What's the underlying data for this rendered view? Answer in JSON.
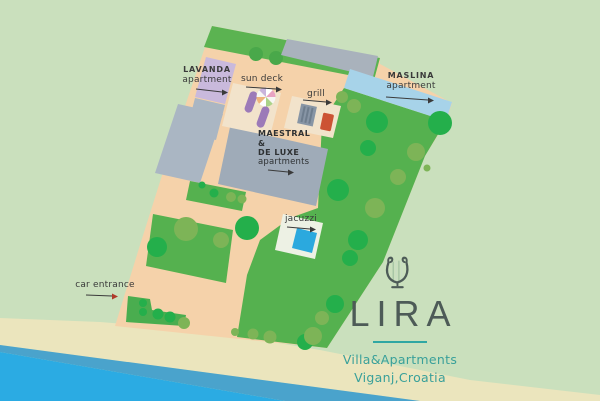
{
  "brand": {
    "name": "LIRA",
    "tagline": "Villa&Apartments",
    "location": "Viganj,Croatia",
    "accent_teal": "#2fa7a3",
    "text_color": "#4d5b57"
  },
  "map": {
    "labels": {
      "lavanda": {
        "title": "LAVANDA",
        "subtitle": "apartment"
      },
      "maslina": {
        "title": "MASLINA",
        "subtitle": "apartment"
      },
      "maestral": {
        "line1": "MAESTRAL",
        "line2": "&",
        "line3": "DE LUXE",
        "line4": "apartments"
      },
      "sun_deck": "sun deck",
      "grill": "grill",
      "jacuzzi": "jacuzzi",
      "car_entrance": "car entrance"
    },
    "colors": {
      "background": "#cae0bd",
      "plot_beige": "#f5d2aa",
      "lawn_green": "#55b14f",
      "tree_bright": "#24af4b",
      "tree_olive": "#7db457",
      "sand": "#ebe5bd",
      "sea": "#2babe3",
      "sea_deep": "#4aa3cc",
      "building_gray": "#9fabb8",
      "lavanda_purple": "#c9b9dc",
      "maslina_blue": "#a7d3e9",
      "jacuzzi_blue": "#2ba9de",
      "grill_red": "#cc5233",
      "lounger_purple": "#9c7ab8",
      "deck_pad": "#f2e3cb",
      "label_text": "#3a3a3a"
    }
  }
}
